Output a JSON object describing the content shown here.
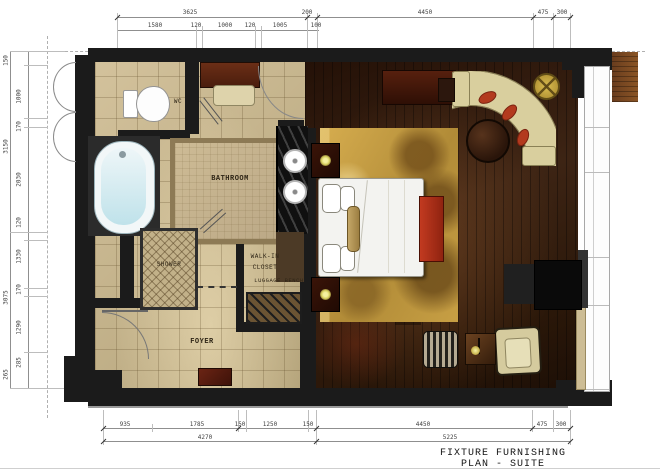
{
  "title": {
    "text": "FIXTURE FURNISHING PLAN - SUITE"
  },
  "rooms": {
    "bathroom": "BATHROOM",
    "wc": "WC",
    "shower": "SHOWER",
    "walkin1": "WALK-IN",
    "walkin2": "CLOSET",
    "luggage": "LUGGAGE BENCH",
    "foyer": "FOYER"
  },
  "dims": {
    "t1a": "3625",
    "t1b": "200",
    "t1c": "4450",
    "t1d": "475",
    "t1e": "300",
    "t2a": "1580",
    "t2b": "120",
    "t2c": "1000",
    "t2d": "120",
    "t2e": "1005",
    "t2f": "100",
    "b1a": "935",
    "b1b": "1785",
    "b1c": "150",
    "b1d": "1250",
    "b1e": "150",
    "b1f": "4450",
    "b1g": "475",
    "b1h": "300",
    "b2a": "4270",
    "b2b": "5225",
    "l1": "150",
    "l2": "1000",
    "l3": "170",
    "l4": "3150",
    "l5": "2030",
    "l6": "120",
    "l7": "1330",
    "l8": "170",
    "l9": "3075",
    "l10": "1290",
    "l11": "285",
    "l12": "265"
  },
  "colors": {
    "wall": "#1b1b1b",
    "tile": "#c6b58f",
    "wood_floor": "#3a2315",
    "rug_gold": "#c9a54b",
    "accent_red": "#a93220",
    "sofa_cream": "#d9cf9e",
    "lamp_glow": "#efe87d"
  }
}
